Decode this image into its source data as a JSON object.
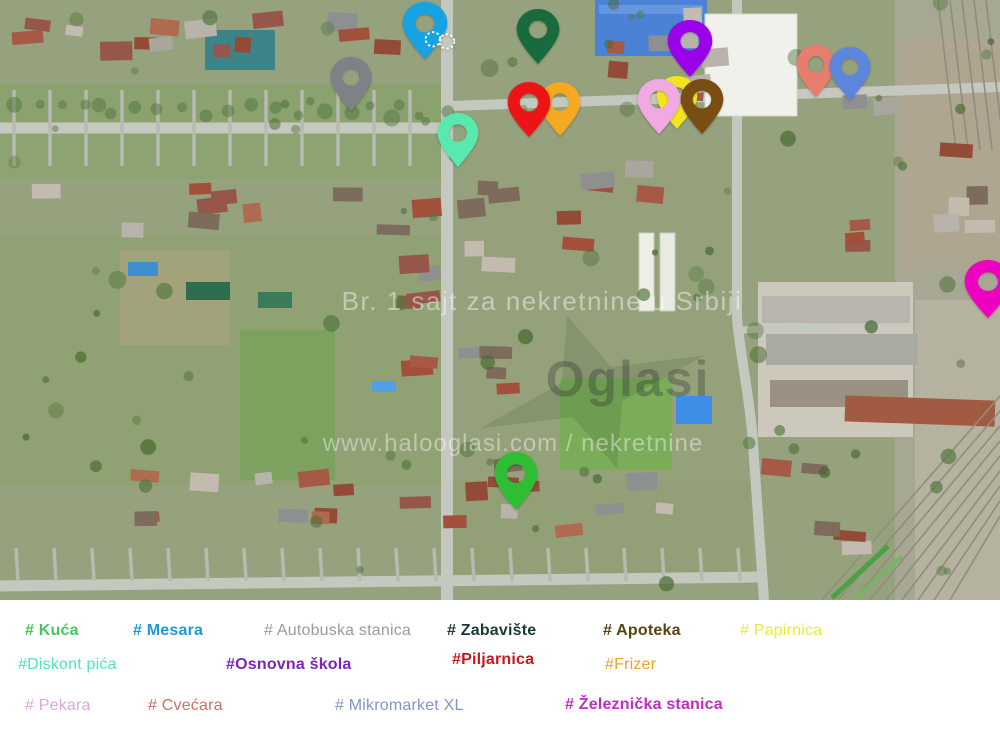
{
  "watermarks": {
    "tagline": "Br. 1 sajt za nekretnine u Srbiji",
    "logo": "Oglasi",
    "url": "www.halooglasi.com / nekretnine"
  },
  "legend": {
    "items": [
      {
        "id": "kuca",
        "label": "# Kuća",
        "color": "#44c95e",
        "bold": true,
        "label_x": 25,
        "label_y": 22,
        "pin": {
          "x": 516,
          "y": 510,
          "w": 44,
          "h": 58,
          "color": "#2fbe33",
          "z": 3
        }
      },
      {
        "id": "mesara",
        "label": "# Mesara",
        "color": "#1e9ad6",
        "bold": true,
        "label_x": 133,
        "label_y": 22,
        "pin": {
          "x": 425,
          "y": 59,
          "w": 46,
          "h": 57,
          "color": "#17a2e4",
          "z": 3,
          "icon": "dotted-wheels"
        }
      },
      {
        "id": "autobuska-stanica",
        "label": "# Autobuska stanica",
        "color": "#9b9b9b",
        "bold": false,
        "label_x": 264,
        "label_y": 22,
        "pin": {
          "x": 351,
          "y": 111,
          "w": 42,
          "h": 54,
          "color": "#7e8186",
          "z": 3
        }
      },
      {
        "id": "zabaviste",
        "label": "# Zabavište",
        "color": "#1c3a35",
        "bold": true,
        "label_x": 447,
        "label_y": 22,
        "pin": {
          "x": 538,
          "y": 64,
          "w": 44,
          "h": 55,
          "color": "#176b3f",
          "z": 3
        }
      },
      {
        "id": "apoteka",
        "label": "# Apoteka",
        "color": "#564413",
        "bold": true,
        "label_x": 603,
        "label_y": 22,
        "pin": {
          "x": 702,
          "y": 134,
          "w": 44,
          "h": 55,
          "color": "#794e13",
          "z": 5
        }
      },
      {
        "id": "papirnica",
        "label": "# Papirnica",
        "color": "#e9e93e",
        "bold": false,
        "label_x": 740,
        "label_y": 22,
        "pin": {
          "x": 677,
          "y": 129,
          "w": 42,
          "h": 53,
          "color": "#f2e51f",
          "z": 1
        }
      },
      {
        "id": "diskont-pica",
        "label": "#Diskont pića",
        "color": "#4fe3c4",
        "bold": false,
        "label_x": 18,
        "label_y": 56,
        "pin": {
          "x": 458,
          "y": 167,
          "w": 42,
          "h": 54,
          "color": "#58e9af",
          "z": 3
        }
      },
      {
        "id": "osnovna-skola",
        "label": "#Osnovna škola",
        "color": "#7b24be",
        "bold": true,
        "label_x": 226,
        "label_y": 56,
        "pin": {
          "x": 690,
          "y": 77,
          "w": 46,
          "h": 57,
          "color": "#9b01e8",
          "z": 3
        }
      },
      {
        "id": "piljarnica",
        "label": "#Piljarnica",
        "color": "#c51a1a",
        "bold": true,
        "label_x": 452,
        "label_y": 51,
        "pin": {
          "x": 529,
          "y": 137,
          "w": 44,
          "h": 55,
          "color": "#ec1414",
          "z": 4
        }
      },
      {
        "id": "frizer",
        "label": "#Frizer",
        "color": "#eda429",
        "bold": false,
        "label_x": 605,
        "label_y": 56,
        "pin": {
          "x": 560,
          "y": 136,
          "w": 42,
          "h": 54,
          "color": "#f6a821",
          "z": 2
        }
      },
      {
        "id": "pekara",
        "label": "# Pekara",
        "color": "#dfa6df",
        "bold": false,
        "label_x": 25,
        "label_y": 97,
        "pin": {
          "x": 659,
          "y": 134,
          "w": 44,
          "h": 55,
          "color": "#f0a9e2",
          "z": 3
        }
      },
      {
        "id": "cvecara",
        "label": "# Cvećara",
        "color": "#cc7166",
        "bold": false,
        "label_x": 148,
        "label_y": 97,
        "pin": {
          "x": 816,
          "y": 97,
          "w": 40,
          "h": 52,
          "color": "#e87c6d",
          "z": 3
        }
      },
      {
        "id": "mikromarket-xl",
        "label": "# Mikromarket XL",
        "color": "#8494ca",
        "bold": false,
        "label_x": 335,
        "label_y": 97,
        "pin": {
          "x": 850,
          "y": 100,
          "w": 42,
          "h": 53,
          "color": "#5c85de",
          "z": 4
        }
      },
      {
        "id": "zeleznicka-stanica",
        "label": "# Železnička stanica",
        "color": "#c32cc3",
        "bold": true,
        "label_x": 565,
        "label_y": 96,
        "pin": {
          "x": 988,
          "y": 318,
          "w": 48,
          "h": 58,
          "color": "#ee00c0",
          "z": 3
        }
      }
    ]
  }
}
